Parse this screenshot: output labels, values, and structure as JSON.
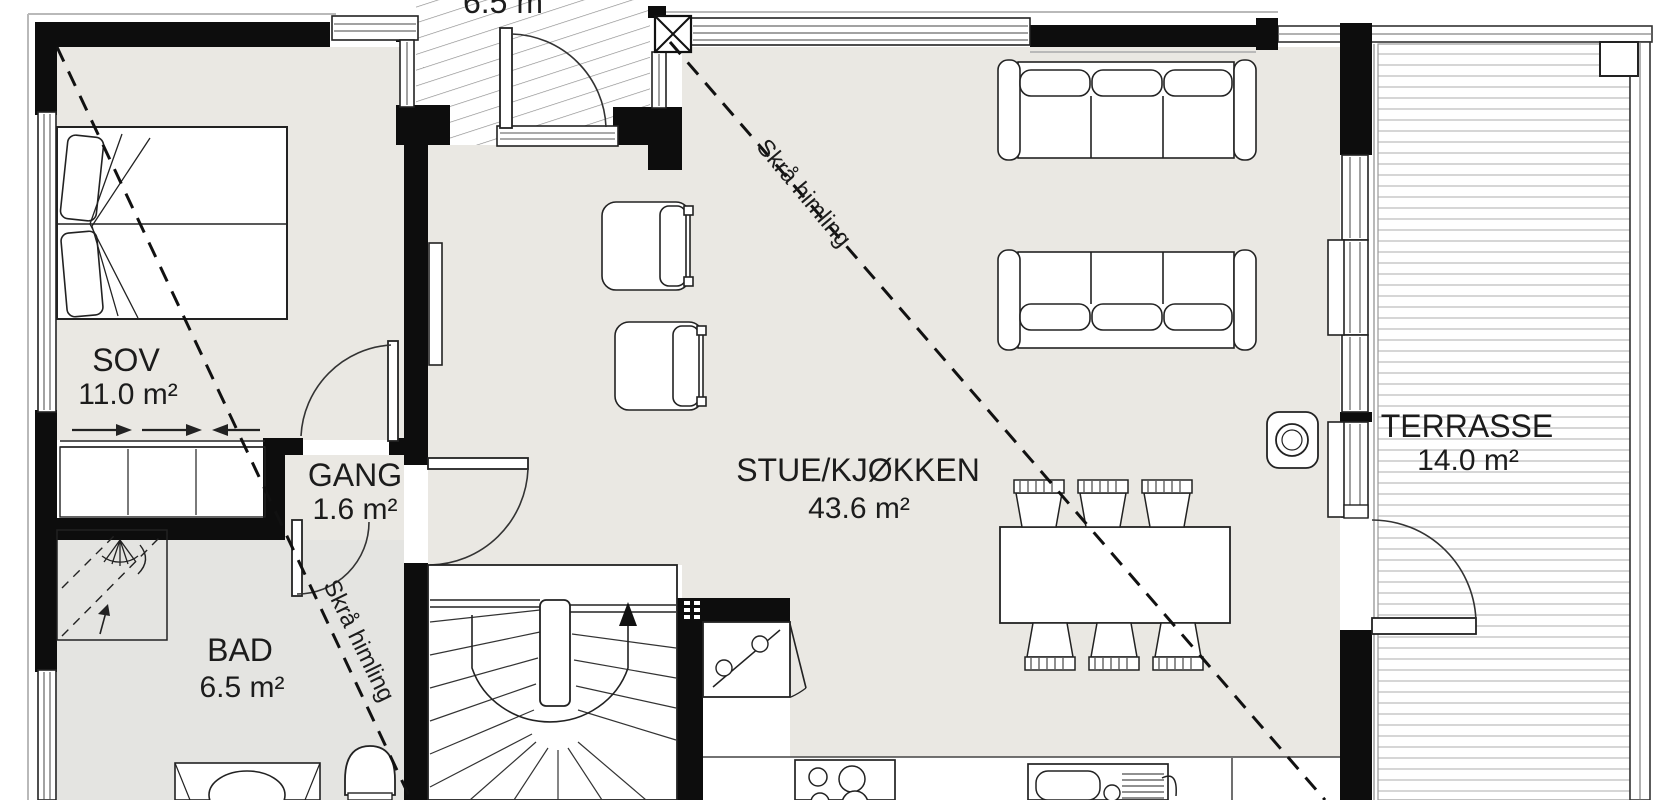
{
  "plan": {
    "rooms": [
      {
        "id": "sov",
        "name": "SOV",
        "area": "11.0 m²"
      },
      {
        "id": "gang",
        "name": "GANG",
        "area": "1.6 m²"
      },
      {
        "id": "bad",
        "name": "BAD",
        "area": "6.5 m²"
      },
      {
        "id": "stue_kjokken",
        "name": "STUE/KJØKKEN",
        "area": "43.6 m²"
      },
      {
        "id": "terrasse",
        "name": "TERRASSE",
        "area": "14.0 m²"
      }
    ],
    "dimension_top": "6.5 m",
    "ceiling_note": "Skrå himling",
    "icons": [
      "double-bed",
      "sliding-wardrobe",
      "shower",
      "shower-head-icon",
      "toilet",
      "vanity-sink",
      "tv",
      "armchair",
      "sofa",
      "dining-table",
      "dining-chair",
      "wood-stove",
      "winder-staircase",
      "stair-up-arrow",
      "fridge-freezer",
      "cooktop",
      "kitchen-sink",
      "entry-door",
      "interior-door",
      "terrace-door",
      "window",
      "entrance-hatch",
      "terrace-decking"
    ],
    "colors": {
      "wall": "#0d0d0d",
      "floor": "#eae8e3",
      "floor_bad": "#e4e4e1",
      "deck_line": "#c9c9c9",
      "hatch_line": "#8a8a8a",
      "outline": "#b9b9b9",
      "text": "#1c1c1c"
    }
  }
}
